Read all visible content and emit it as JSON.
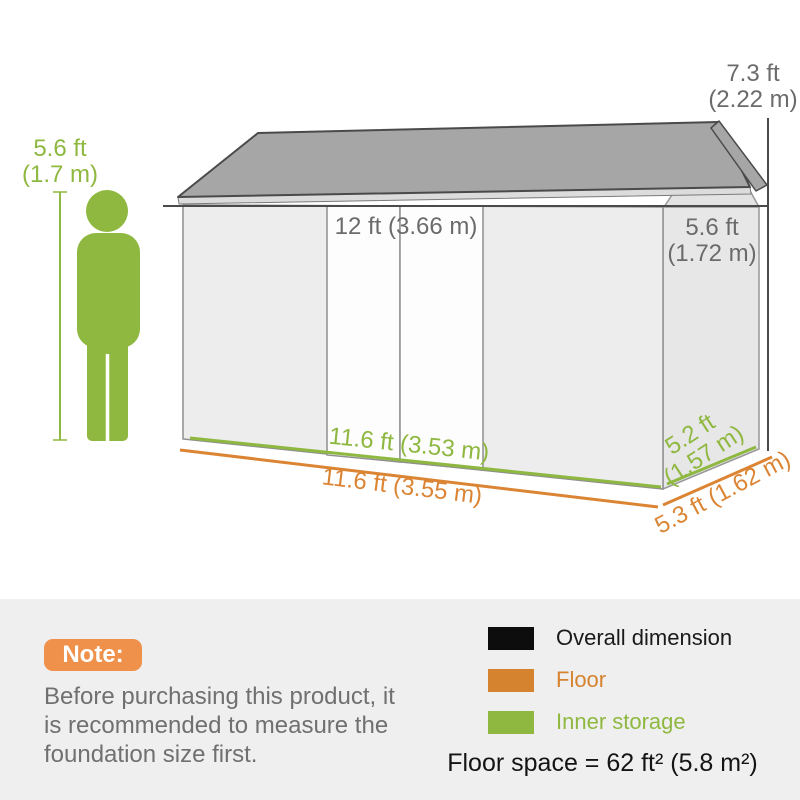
{
  "diagram": {
    "person_height": {
      "line1": "5.6 ft",
      "line2": "(1.7 m)"
    },
    "overall_height": {
      "line1": "7.3 ft",
      "line2": "(2.22 m)"
    },
    "overall_width": "12 ft (3.66 m)",
    "gable_width": {
      "line1": "5.6 ft",
      "line2": "(1.72 m)"
    },
    "inner_length": "11.6 ft (3.53 m)",
    "floor_length": "11.6 ft (3.55 m)",
    "inner_depth": {
      "line1": "5.2 ft",
      "line2": "(1.57 m)"
    },
    "floor_depth": "5.3 ft (1.62 m)",
    "colors": {
      "overall_dimension": "#4a4a4a",
      "floor": "#db8534",
      "inner_storage": "#8fb840",
      "roof": "#a6a6a6",
      "wall": "#ededed"
    }
  },
  "footer": {
    "note_badge": "Note:",
    "note_lines": [
      "Before purchasing this product, it",
      "is recommended to measure the",
      "foundation size first."
    ],
    "legend": [
      {
        "label": "Overall dimension",
        "swatch": "#0d0d0d"
      },
      {
        "label": "Floor",
        "swatch": "#d6832f"
      },
      {
        "label": "Inner storage",
        "swatch": "#8fb840"
      }
    ],
    "floor_space": "Floor space = 62 ft² (5.8 m²)"
  }
}
